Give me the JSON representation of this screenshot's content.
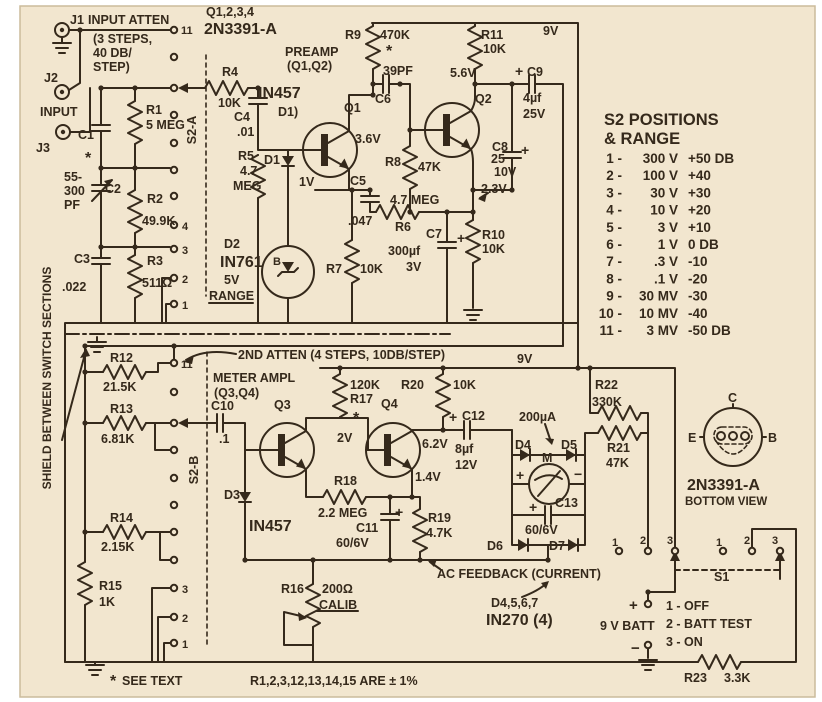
{
  "colors": {
    "paper": "#f2e6cf",
    "ink": "#35291b",
    "frame": "#ffffff"
  },
  "panel_s2": {
    "title1": "S2 POSITIONS",
    "title2": "& RANGE",
    "rows": [
      {
        "pos": "1",
        "range": "300 V",
        "db": "+50 DB"
      },
      {
        "pos": "2",
        "range": "100 V",
        "db": "+40"
      },
      {
        "pos": "3",
        "range": "30 V",
        "db": "+30"
      },
      {
        "pos": "4",
        "range": "10 V",
        "db": "+20"
      },
      {
        "pos": "5",
        "range": "3 V",
        "db": "+10"
      },
      {
        "pos": "6",
        "range": "1 V",
        "db": "0 DB"
      },
      {
        "pos": "7",
        "range": ".3 V",
        "db": "-10"
      },
      {
        "pos": "8",
        "range": ".1 V",
        "db": "-20"
      },
      {
        "pos": "9",
        "range": "30 MV",
        "db": "-30"
      },
      {
        "pos": "10",
        "range": "10 MV",
        "db": "-40"
      },
      {
        "pos": "11",
        "range": "3 MV",
        "db": "-50 DB"
      }
    ]
  },
  "switch_s1": {
    "label": "S1",
    "positions": [
      "1 - OFF",
      "2 - BATT TEST",
      "3 - ON"
    ]
  },
  "texts": [
    {
      "name": "j1-label",
      "text": "J1",
      "x": 70,
      "y": 24
    },
    {
      "name": "input-atten-label",
      "text": "INPUT ATTEN",
      "x": 88,
      "y": 24
    },
    {
      "name": "atten-note-1",
      "text": "(3 STEPS,",
      "x": 93,
      "y": 43
    },
    {
      "name": "atten-note-2",
      "text": "40 DB/",
      "x": 93,
      "y": 57
    },
    {
      "name": "atten-note-3",
      "text": "STEP)",
      "x": 93,
      "y": 71
    },
    {
      "name": "j2-label",
      "text": "J2",
      "x": 44,
      "y": 82
    },
    {
      "name": "input-label",
      "text": "INPUT",
      "x": 40,
      "y": 116
    },
    {
      "name": "j3-label",
      "text": "J3",
      "x": 36,
      "y": 152
    },
    {
      "name": "c1-label",
      "text": "C1",
      "x": 78,
      "y": 139
    },
    {
      "name": "c1-star",
      "text": "*",
      "x": 85,
      "y": 163,
      "size": 16
    },
    {
      "name": "r1-label",
      "text": "R1",
      "x": 146,
      "y": 114
    },
    {
      "name": "r1-value",
      "text": "5 MEG",
      "x": 146,
      "y": 129
    },
    {
      "name": "c2-value-1",
      "text": "55-",
      "x": 64,
      "y": 181
    },
    {
      "name": "c2-value-2",
      "text": "300",
      "x": 64,
      "y": 195
    },
    {
      "name": "c2-value-3",
      "text": "PF",
      "x": 64,
      "y": 209
    },
    {
      "name": "c2-label",
      "text": "C2",
      "x": 105,
      "y": 193
    },
    {
      "name": "r2-label",
      "text": "R2",
      "x": 147,
      "y": 203
    },
    {
      "name": "r2-value",
      "text": "49.9K",
      "x": 142,
      "y": 225
    },
    {
      "name": "c3-label",
      "text": "C3",
      "x": 74,
      "y": 263
    },
    {
      "name": "c3-value",
      "text": ".022",
      "x": 62,
      "y": 291
    },
    {
      "name": "r3-label",
      "text": "R3",
      "x": 147,
      "y": 265
    },
    {
      "name": "r3-value",
      "text": "511Ω",
      "x": 142,
      "y": 287
    },
    {
      "name": "s2a-label",
      "text": "S2-A",
      "x": 196,
      "y": 130,
      "rotate": -90,
      "anchor": "middle"
    },
    {
      "name": "s2a-pos-11",
      "text": "11",
      "x": 181,
      "y": 34,
      "size": 11
    },
    {
      "name": "s2a-pos-4",
      "text": "4",
      "x": 182,
      "y": 230,
      "size": 11
    },
    {
      "name": "s2a-pos-3",
      "text": "3",
      "x": 182,
      "y": 254,
      "size": 11
    },
    {
      "name": "s2a-pos-2",
      "text": "2",
      "x": 182,
      "y": 283,
      "size": 11
    },
    {
      "name": "s2a-pos-1",
      "text": "1",
      "x": 182,
      "y": 309,
      "size": 11
    },
    {
      "name": "q-note-1",
      "text": "Q1,2,3,4",
      "x": 206,
      "y": 16
    },
    {
      "name": "q-note-2",
      "text": "2N3391-A",
      "x": 204,
      "y": 34,
      "size": 16
    },
    {
      "name": "r4-label",
      "text": "R4",
      "x": 222,
      "y": 76
    },
    {
      "name": "r4-value",
      "text": "10K",
      "x": 218,
      "y": 107
    },
    {
      "name": "d1-part",
      "text": "IN457",
      "x": 258,
      "y": 98,
      "size": 16
    },
    {
      "name": "d1-pointer",
      "text": "D1)",
      "x": 278,
      "y": 116
    },
    {
      "name": "d1-label",
      "text": "D1",
      "x": 264,
      "y": 164
    },
    {
      "name": "c4-label",
      "text": "C4",
      "x": 234,
      "y": 121
    },
    {
      "name": "c4-value",
      "text": ".01",
      "x": 237,
      "y": 136
    },
    {
      "name": "r5-label",
      "text": "R5",
      "x": 238,
      "y": 160
    },
    {
      "name": "r5-value-1",
      "text": "4.7",
      "x": 240,
      "y": 175
    },
    {
      "name": "r5-value-2",
      "text": "MEG",
      "x": 233,
      "y": 190
    },
    {
      "name": "d2-label",
      "text": "D2",
      "x": 224,
      "y": 248
    },
    {
      "name": "d2-part",
      "text": "IN761",
      "x": 220,
      "y": 267,
      "size": 16
    },
    {
      "name": "d2-value",
      "text": "5V",
      "x": 224,
      "y": 284
    },
    {
      "name": "d2-b",
      "text": "B",
      "x": 273,
      "y": 265,
      "size": 11
    },
    {
      "name": "range-label",
      "text": "RANGE",
      "x": 209,
      "y": 300
    },
    {
      "name": "preamp-1",
      "text": "PREAMP",
      "x": 285,
      "y": 56
    },
    {
      "name": "preamp-2",
      "text": "(Q1,Q2)",
      "x": 287,
      "y": 70
    },
    {
      "name": "q1-label",
      "text": "Q1",
      "x": 344,
      "y": 112
    },
    {
      "name": "q1-collector-v",
      "text": "3.6V",
      "x": 355,
      "y": 143
    },
    {
      "name": "q1-emitter-v",
      "text": "1V",
      "x": 299,
      "y": 186
    },
    {
      "name": "r9-label",
      "text": "R9",
      "x": 345,
      "y": 39
    },
    {
      "name": "r9-value",
      "text": "470K",
      "x": 380,
      "y": 39
    },
    {
      "name": "r9-star",
      "text": "*",
      "x": 386,
      "y": 56,
      "size": 16
    },
    {
      "name": "c6-value",
      "text": "39PF",
      "x": 383,
      "y": 75
    },
    {
      "name": "c6-label",
      "text": "C6",
      "x": 375,
      "y": 103
    },
    {
      "name": "r8-label",
      "text": "R8",
      "x": 385,
      "y": 166
    },
    {
      "name": "r8-value",
      "text": "47K",
      "x": 418,
      "y": 171
    },
    {
      "name": "c5-label",
      "text": "C5",
      "x": 350,
      "y": 185
    },
    {
      "name": "c5-value",
      "text": ".047",
      "x": 348,
      "y": 225
    },
    {
      "name": "r6-value",
      "text": "4.7 MEG",
      "x": 390,
      "y": 204
    },
    {
      "name": "r6-label",
      "text": "R6",
      "x": 395,
      "y": 231
    },
    {
      "name": "r7-label",
      "text": "R7",
      "x": 326,
      "y": 273
    },
    {
      "name": "r7-value",
      "text": "10K",
      "x": 360,
      "y": 273
    },
    {
      "name": "c7-label",
      "text": "C7",
      "x": 426,
      "y": 238
    },
    {
      "name": "c7-plus",
      "text": "+",
      "x": 457,
      "y": 243,
      "size": 14
    },
    {
      "name": "c7-value-1",
      "text": "300µf",
      "x": 388,
      "y": 255
    },
    {
      "name": "c7-value-2",
      "text": "3V",
      "x": 406,
      "y": 271
    },
    {
      "name": "r10-label",
      "text": "R10",
      "x": 482,
      "y": 239
    },
    {
      "name": "r10-value",
      "text": "10K",
      "x": 482,
      "y": 253
    },
    {
      "name": "q2-emitter-v",
      "text": "2.3V",
      "x": 481,
      "y": 193
    },
    {
      "name": "q2-label",
      "text": "Q2",
      "x": 475,
      "y": 103
    },
    {
      "name": "r11-label",
      "text": "R11",
      "x": 481,
      "y": 39
    },
    {
      "name": "r11-value",
      "text": "10K",
      "x": 483,
      "y": 53
    },
    {
      "name": "q2-base-v",
      "text": "5.6V",
      "x": 450,
      "y": 77
    },
    {
      "name": "supply-9v-top",
      "text": "9V",
      "x": 543,
      "y": 35
    },
    {
      "name": "c9-plus",
      "text": "+",
      "x": 515,
      "y": 76,
      "size": 14
    },
    {
      "name": "c9-label",
      "text": "C9",
      "x": 527,
      "y": 76
    },
    {
      "name": "c9-value-1",
      "text": "4µf",
      "x": 523,
      "y": 102
    },
    {
      "name": "c9-value-2",
      "text": "25V",
      "x": 523,
      "y": 118
    },
    {
      "name": "c8-label",
      "text": "C8",
      "x": 492,
      "y": 151
    },
    {
      "name": "c8-value-1",
      "text": "25",
      "x": 491,
      "y": 163
    },
    {
      "name": "c8-value-2",
      "text": "10V",
      "x": 494,
      "y": 176
    },
    {
      "name": "c8-plus",
      "text": "+",
      "x": 521,
      "y": 155,
      "size": 14
    },
    {
      "name": "shield-note",
      "text": "SHIELD BETWEEN SWITCH SECTIONS",
      "x": 51,
      "y": 378,
      "rotate": -90,
      "anchor": "middle",
      "size": 12
    },
    {
      "name": "second-atten-note",
      "text": "2ND ATTEN (4 STEPS, 10DB/STEP)",
      "x": 238,
      "y": 359
    },
    {
      "name": "meter-ampl-1",
      "text": "METER AMPL",
      "x": 213,
      "y": 382
    },
    {
      "name": "meter-ampl-2",
      "text": "(Q3,Q4)",
      "x": 214,
      "y": 397
    },
    {
      "name": "r12-label",
      "text": "R12",
      "x": 110,
      "y": 362
    },
    {
      "name": "r12-value",
      "text": "21.5K",
      "x": 103,
      "y": 391
    },
    {
      "name": "r13-label",
      "text": "R13",
      "x": 110,
      "y": 413
    },
    {
      "name": "r13-value",
      "text": "6.81K",
      "x": 101,
      "y": 443
    },
    {
      "name": "c10-label",
      "text": "C10",
      "x": 211,
      "y": 410
    },
    {
      "name": "c10-value",
      "text": ".1",
      "x": 219,
      "y": 443
    },
    {
      "name": "s2b-label",
      "text": "S2-B",
      "x": 198,
      "y": 470,
      "rotate": -90,
      "anchor": "middle"
    },
    {
      "name": "s2b-pos-11",
      "text": "11",
      "x": 181,
      "y": 368,
      "size": 11
    },
    {
      "name": "s2b-pos-3",
      "text": "3",
      "x": 182,
      "y": 593,
      "size": 11
    },
    {
      "name": "s2b-pos-2",
      "text": "2",
      "x": 182,
      "y": 622,
      "size": 11
    },
    {
      "name": "s2b-pos-1",
      "text": "1",
      "x": 182,
      "y": 648,
      "size": 11
    },
    {
      "name": "r14-label",
      "text": "R14",
      "x": 110,
      "y": 522
    },
    {
      "name": "r14-value",
      "text": "2.15K",
      "x": 101,
      "y": 551
    },
    {
      "name": "r15-label",
      "text": "R15",
      "x": 99,
      "y": 590
    },
    {
      "name": "r15-value",
      "text": "1K",
      "x": 99,
      "y": 606
    },
    {
      "name": "q3-label",
      "text": "Q3",
      "x": 274,
      "y": 409
    },
    {
      "name": "d3-label",
      "text": "D3",
      "x": 224,
      "y": 499
    },
    {
      "name": "d3-part",
      "text": "IN457",
      "x": 249,
      "y": 531,
      "size": 16
    },
    {
      "name": "r17-value",
      "text": "120K",
      "x": 350,
      "y": 389
    },
    {
      "name": "r17-label",
      "text": "R17",
      "x": 350,
      "y": 403
    },
    {
      "name": "r17-star",
      "text": "*",
      "x": 353,
      "y": 423,
      "size": 16
    },
    {
      "name": "q4-label",
      "text": "Q4",
      "x": 381,
      "y": 408
    },
    {
      "name": "q3-collector-v",
      "text": "2V",
      "x": 337,
      "y": 442
    },
    {
      "name": "r18-label",
      "text": "R18",
      "x": 334,
      "y": 485
    },
    {
      "name": "r18-value",
      "text": "2.2 MEG",
      "x": 318,
      "y": 517
    },
    {
      "name": "q4-emitter-v",
      "text": "1.4V",
      "x": 415,
      "y": 481
    },
    {
      "name": "c11-plus",
      "text": "+",
      "x": 395,
      "y": 517,
      "size": 14
    },
    {
      "name": "c11-label",
      "text": "C11",
      "x": 356,
      "y": 532
    },
    {
      "name": "c11-value",
      "text": "60/6V",
      "x": 336,
      "y": 547
    },
    {
      "name": "r19-label",
      "text": "R19",
      "x": 428,
      "y": 522
    },
    {
      "name": "r19-value",
      "text": "4.7K",
      "x": 426,
      "y": 537
    },
    {
      "name": "r20-label",
      "text": "R20",
      "x": 401,
      "y": 389
    },
    {
      "name": "r20-value",
      "text": "10K",
      "x": 453,
      "y": 389
    },
    {
      "name": "supply-9v-low",
      "text": "9V",
      "x": 517,
      "y": 363
    },
    {
      "name": "q4-collector-v",
      "text": "6.2V",
      "x": 422,
      "y": 448
    },
    {
      "name": "c12-plus",
      "text": "+",
      "x": 449,
      "y": 422,
      "size": 14
    },
    {
      "name": "c12-label",
      "text": "C12",
      "x": 462,
      "y": 420
    },
    {
      "name": "c12-value-1",
      "text": "8µf",
      "x": 455,
      "y": 453
    },
    {
      "name": "c12-value-2",
      "text": "12V",
      "x": 455,
      "y": 469
    },
    {
      "name": "meter-value",
      "text": "200µA",
      "x": 519,
      "y": 421
    },
    {
      "name": "d4-label",
      "text": "D4",
      "x": 515,
      "y": 449
    },
    {
      "name": "d5-label",
      "text": "D5",
      "x": 561,
      "y": 449
    },
    {
      "name": "meter-label",
      "text": "M",
      "x": 542,
      "y": 462
    },
    {
      "name": "meter-plus",
      "text": "+",
      "x": 516,
      "y": 480,
      "size": 14
    },
    {
      "name": "meter-minus",
      "text": "−",
      "x": 574,
      "y": 479,
      "size": 14
    },
    {
      "name": "c13-label",
      "text": "C13",
      "x": 555,
      "y": 507
    },
    {
      "name": "c13-plus",
      "text": "+",
      "x": 529,
      "y": 512,
      "size": 14
    },
    {
      "name": "c13-value",
      "text": "60/6V",
      "x": 525,
      "y": 534
    },
    {
      "name": "d6-label",
      "text": "D6",
      "x": 487,
      "y": 550
    },
    {
      "name": "d7-label",
      "text": "D7",
      "x": 549,
      "y": 550
    },
    {
      "name": "r22-label",
      "text": "R22",
      "x": 595,
      "y": 389
    },
    {
      "name": "r22-value",
      "text": "330K",
      "x": 592,
      "y": 406
    },
    {
      "name": "r21-label",
      "text": "R21",
      "x": 607,
      "y": 452
    },
    {
      "name": "r21-value",
      "text": "47K",
      "x": 606,
      "y": 467
    },
    {
      "name": "ac-feedback-note",
      "text": "AC FEEDBACK (CURRENT)",
      "x": 437,
      "y": 578
    },
    {
      "name": "d4567-label",
      "text": "D4,5,6,7",
      "x": 491,
      "y": 607
    },
    {
      "name": "d4567-part",
      "text": "IN270 (4)",
      "x": 486,
      "y": 625,
      "size": 16
    },
    {
      "name": "r16-label",
      "text": "R16",
      "x": 281,
      "y": 593
    },
    {
      "name": "r16-value",
      "text": "200Ω",
      "x": 322,
      "y": 593
    },
    {
      "name": "r16-calib",
      "text": "CALIB",
      "x": 319,
      "y": 609
    },
    {
      "name": "see-text-star",
      "text": "*",
      "x": 110,
      "y": 686,
      "size": 16
    },
    {
      "name": "see-text-note",
      "text": "SEE TEXT",
      "x": 122,
      "y": 685
    },
    {
      "name": "tolerance-note",
      "text": "R1,2,3,12,13,14,15 ARE ± 1%",
      "x": 250,
      "y": 685
    },
    {
      "name": "batt-plus",
      "text": "+",
      "x": 629,
      "y": 610,
      "size": 15
    },
    {
      "name": "batt-label",
      "text": "9 V BATT",
      "x": 600,
      "y": 630
    },
    {
      "name": "batt-minus",
      "text": "−",
      "x": 631,
      "y": 653,
      "size": 15
    },
    {
      "name": "s1-label",
      "text": "S1",
      "x": 714,
      "y": 581
    },
    {
      "name": "s1a-pos-1",
      "text": "1",
      "x": 612,
      "y": 546,
      "size": 11
    },
    {
      "name": "s1a-pos-2",
      "text": "2",
      "x": 640,
      "y": 544,
      "size": 11
    },
    {
      "name": "s1a-pos-3",
      "text": "3",
      "x": 667,
      "y": 544,
      "size": 11
    },
    {
      "name": "s1b-pos-1",
      "text": "1",
      "x": 716,
      "y": 546,
      "size": 11
    },
    {
      "name": "s1b-pos-2",
      "text": "2",
      "x": 744,
      "y": 544,
      "size": 11
    },
    {
      "name": "s1b-pos-3",
      "text": "3",
      "x": 772,
      "y": 544,
      "size": 11
    },
    {
      "name": "r23-label",
      "text": "R23",
      "x": 684,
      "y": 682
    },
    {
      "name": "r23-value",
      "text": "3.3K",
      "x": 724,
      "y": 682
    },
    {
      "name": "bv-c",
      "text": "C",
      "x": 728,
      "y": 402
    },
    {
      "name": "bv-e",
      "text": "E",
      "x": 688,
      "y": 442
    },
    {
      "name": "bv-b",
      "text": "B",
      "x": 768,
      "y": 442
    },
    {
      "name": "bv-part",
      "text": "2N3391-A",
      "x": 687,
      "y": 490,
      "size": 16
    },
    {
      "name": "bv-note",
      "text": "BOTTOM VIEW",
      "x": 685,
      "y": 505,
      "size": 11.5
    }
  ]
}
